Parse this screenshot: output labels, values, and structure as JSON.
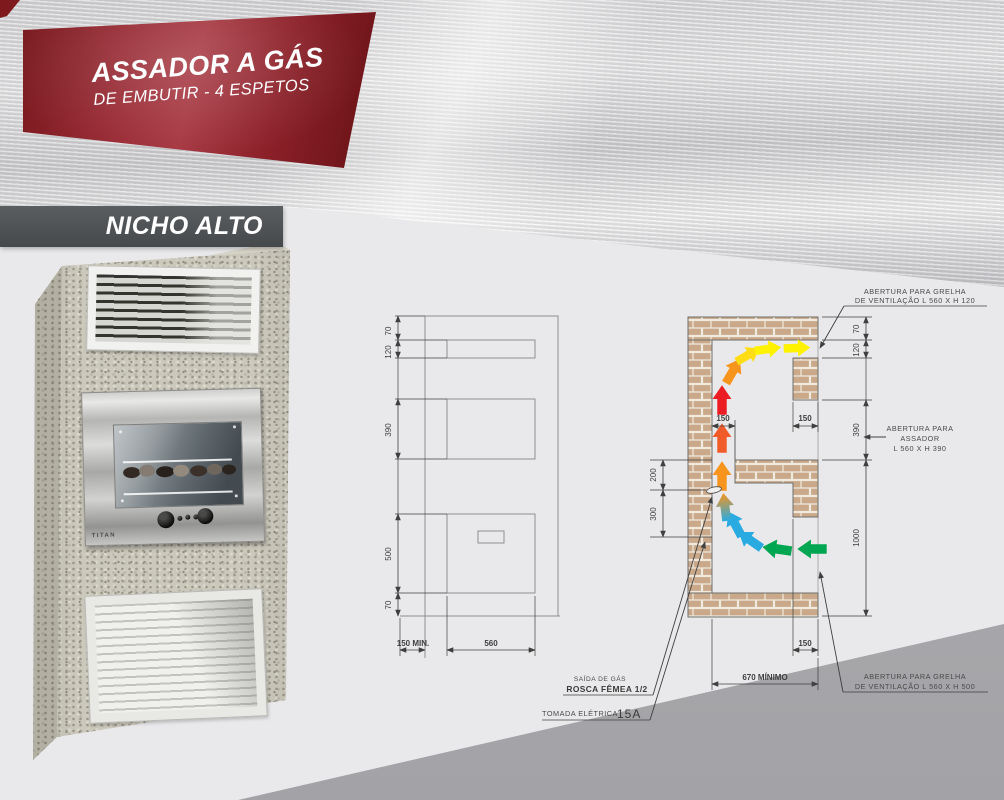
{
  "header": {
    "title": "ASSADOR A GÁS",
    "subtitle": "DE EMBUTIR - 4 ESPETOS"
  },
  "section": {
    "label": "NICHO ALTO"
  },
  "product": {
    "brand": "TITAN"
  },
  "front_view": {
    "dim_top": "70",
    "dim_vent_top": "120",
    "dim_roaster": "390",
    "dim_vent_bottom": "500",
    "dim_bottom": "70",
    "dim_side_min": "150 MIN.",
    "dim_width": "560"
  },
  "side_view": {
    "dim_top": "70",
    "dim_vent_top": "120",
    "dim_roaster": "390",
    "dim_lower_total": "1000",
    "dim_duct_depth": "150",
    "dim_front_depth": "150",
    "dim_bottom_depth": "150",
    "dim_gas_offset": "200",
    "dim_socket_offset": "300",
    "dim_depth_min": "670 MÍNIMO",
    "note_top_line1": "ABERTURA PARA GRELHA",
    "note_top_line2": "DE VENTILAÇÃO L 560 X H 120",
    "note_mid_line1": "ABERTURA PARA",
    "note_mid_line2": "ASSADOR",
    "note_mid_line3": "L 560 X H 390",
    "note_bottom_line1": "ABERTURA PARA GRELHA",
    "note_bottom_line2": "DE VENTILAÇÃO L 560 X H 500",
    "gas_line1": "SAÍDA DE GÁS",
    "gas_line2": "ROSCA FÊMEA 1/2",
    "socket_label": "TOMADA ELÉTRICA",
    "socket_value": "15A"
  },
  "colors": {
    "banner_red": "#9b2630",
    "banner_gray": "#4b4f51",
    "brick": "#c9a98a",
    "flow_hot": "#ec1c24",
    "flow_warm": "#f7941d",
    "flow_exhaust": "#fff200",
    "flow_cool": "#29abe2",
    "flow_intake": "#00a651"
  }
}
